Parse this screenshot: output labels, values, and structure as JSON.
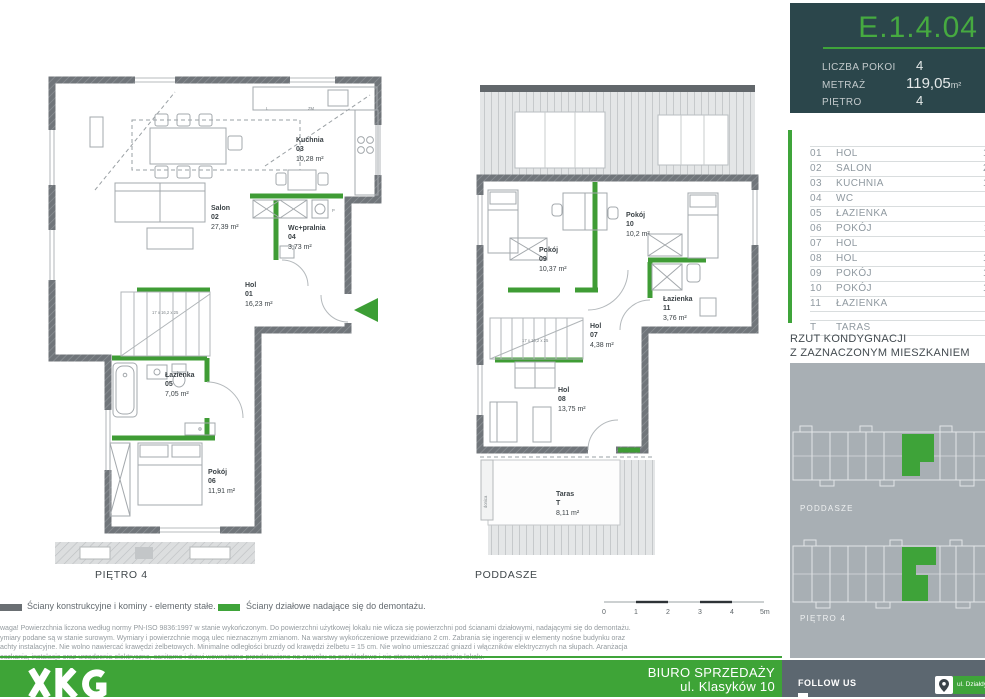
{
  "unit_card": {
    "code": "E.1.4.04",
    "specs": [
      {
        "label": "LICZBA POKOI",
        "value": "4",
        "unit": ""
      },
      {
        "label": "METRAŻ",
        "value": "119,05",
        "unit": "m²"
      },
      {
        "label": "PIĘTRO",
        "value": "4",
        "unit": ""
      }
    ]
  },
  "room_table": {
    "rows": [
      {
        "no": "01",
        "name": "HOL",
        "area": "16,23"
      },
      {
        "no": "02",
        "name": "SALON",
        "area": "27,39"
      },
      {
        "no": "03",
        "name": "KUCHNIA",
        "area": "10,28"
      },
      {
        "no": "04",
        "name": "WC",
        "area": "3,73"
      },
      {
        "no": "05",
        "name": "ŁAZIENKA",
        "area": "7,05"
      },
      {
        "no": "06",
        "name": "POKÓJ",
        "area": "11,91"
      },
      {
        "no": "07",
        "name": "HOL",
        "area": "4,38"
      },
      {
        "no": "08",
        "name": "HOL",
        "area": "13,75"
      },
      {
        "no": "09",
        "name": "POKÓJ",
        "area": "10,37"
      },
      {
        "no": "10",
        "name": "POKÓJ",
        "area": "10,20"
      },
      {
        "no": "11",
        "name": "ŁAZIENKA",
        "area": "3,76"
      }
    ],
    "terrace_row": {
      "no": "T",
      "name": "TARAS",
      "area": "8,11"
    }
  },
  "location_section": {
    "title_line1": "RZUT KONDYGNACJI",
    "title_line2": "Z ZAZNACZONYM MIESZKANIEM",
    "mini_plan_labels": [
      "PODDASZE",
      "PIĘTRO 4"
    ]
  },
  "plan_lower": {
    "caption": "PIĘTRO 4",
    "rooms": [
      {
        "name": "Salon",
        "no": "02",
        "area": "27,39 m²"
      },
      {
        "name": "Kuchnia",
        "no": "03",
        "area": "10,28 m²"
      },
      {
        "name": "Wc+pralnia",
        "no": "04",
        "area": "3,73 m²"
      },
      {
        "name": "Hol",
        "no": "01",
        "area": "16,23 m²"
      },
      {
        "name": "Łazienka",
        "no": "05",
        "area": "7,05 m²"
      },
      {
        "name": "Pokój",
        "no": "06",
        "area": "11,91 m²"
      }
    ],
    "stair_note": "17 x 16,2 x 25",
    "annotations": {
      "fridge": "L",
      "dishwasher": "ZM",
      "washer": "P"
    }
  },
  "plan_upper": {
    "caption": "PODDASZE",
    "rooms": [
      {
        "name": "Pokój",
        "no": "09",
        "area": "10,37 m²"
      },
      {
        "name": "Pokój",
        "no": "10",
        "area": "10,2 m²"
      },
      {
        "name": "Łazienka",
        "no": "11",
        "area": "3,76 m²"
      },
      {
        "name": "Hol",
        "no": "07",
        "area": "4,38 m²"
      },
      {
        "name": "Hol",
        "no": "08",
        "area": "13,75 m²"
      },
      {
        "name": "Taras",
        "no": "T",
        "area": "8,11 m²"
      }
    ],
    "stair_note": "17 x 16,2 x 25",
    "planter_label": "donica"
  },
  "legend": {
    "structural": "Ściany konstrukcyjne i kominy - elementy stałe.",
    "partition": "Ściany działowe nadające się do demontażu."
  },
  "scale_bar": {
    "ticks": [
      "0",
      "1",
      "2",
      "3",
      "4",
      "5m"
    ]
  },
  "disclaimer_lines": [
    "waga! Powierzchnia liczona według normy PN-ISO 9836:1997 w stanie wykończonym. Do powierzchni użytkowej lokalu nie wlicza się powierzchni pod ścianami działowymi, nadającymi się do demontażu.",
    "ymiary podane są w stanie surowym. Wymiary i powierzchnie mogą ulec nieznacznym zmianom. Na warstwy wykończeniowe przewidziano 2 cm. Zabrania się ingerencji w elementy nośne budynku oraz",
    "achty instalacyjne. Nie wolno nawiercać krawędzi żelbetowych. Minimalne odległości bruzdy od krawędzi żelbetu = 15 cm. Nie wolno umieszczać gniazd i włączników elektrycznych na słupach. Aranżacja",
    "eszkania, instalacje oraz urządzenia elektryczne, sanitarne i drzwi wewnętrzne przedstawione na rysunku są przykładowe i nie stanową wyposażenia lokalu."
  ],
  "footer": {
    "sales_office_line1": "BIURO SPRZEDAŻY",
    "sales_office_line2": "ul. Klasyków 10",
    "follow_us": "FOLLOW US",
    "address_badge": "ul. Działdy 7"
  },
  "colors": {
    "accent_green": "#3fa43a",
    "wall_green": "#3f9c35",
    "header_bg": "#2b464b",
    "panel_gray": "#a8afb4",
    "footer_slate": "#5c6770"
  }
}
